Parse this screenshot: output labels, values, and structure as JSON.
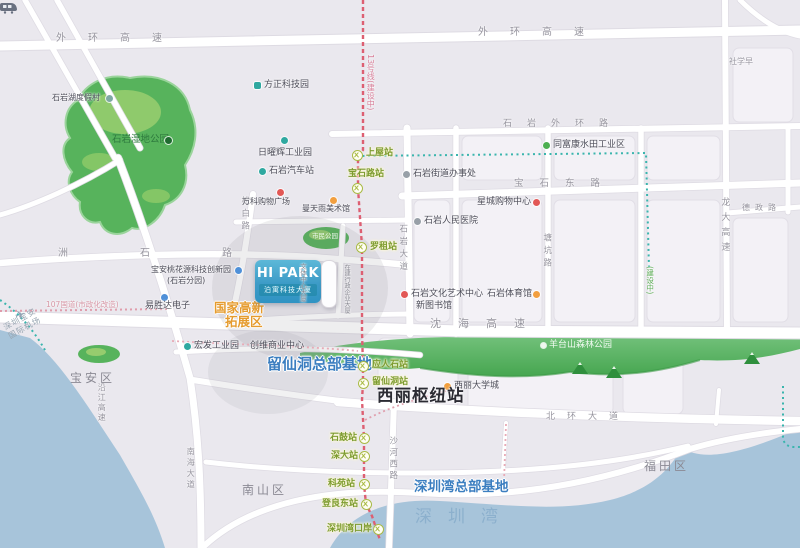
{
  "colors": {
    "brand_blue": "#3d9bc7",
    "hq_blue": "#3b7ec0",
    "zone_orange": "#e59b2e",
    "line13_red": "#dd5f72",
    "metro_teal": "#3ab5ad",
    "park_green": "#53b357",
    "water_blue": "#a7c4da"
  },
  "map": {
    "brand": {
      "title": "HI PARK",
      "subtitle": "泊寓科技大厦"
    },
    "expressways": [
      {
        "label": "外环高速"
      },
      {
        "label": "外环高速"
      },
      {
        "label": "沈海高速"
      },
      {
        "label": "龙大高速"
      }
    ],
    "roads": [
      {
        "label": "洲石路"
      },
      {
        "label": "石岩外环路"
      },
      {
        "label": "宝石东路"
      },
      {
        "label": "德政路"
      },
      {
        "label": "松白路"
      },
      {
        "label": "石岩大道"
      },
      {
        "label": "塘坑路"
      },
      {
        "label": "沙河西路"
      },
      {
        "label": "北环大道"
      },
      {
        "label": "南海大道"
      },
      {
        "label": "沿江高速"
      },
      {
        "label": "107国道(市政化改造)"
      }
    ],
    "districts": [
      {
        "label": "宝安区"
      },
      {
        "label": "南山区"
      },
      {
        "label": "福田区"
      }
    ],
    "water": {
      "bay_label": "深圳湾"
    },
    "parks": [
      {
        "label": "石岩湿地公园"
      },
      {
        "label": "羊台山森林公园"
      },
      {
        "label": "市民公园"
      }
    ],
    "zones": {
      "hi_tech_line1": "国家高新",
      "hi_tech_line2": "拓展区",
      "liuxiandong": "留仙洞总部基地",
      "shenzhenwan": "深圳湾总部基地"
    },
    "hub": {
      "label": "西丽枢纽站"
    },
    "airport": {
      "icon": "✈",
      "line1": "深圳宝安",
      "line2": "国际机场"
    },
    "buildings": [
      {
        "label": "文体中心大厦"
      },
      {
        "label": "在建行政企业大厦"
      }
    ],
    "pois": [
      {
        "label": "石岩湖度假村"
      },
      {
        "label": "方正科技园"
      },
      {
        "label": "日曜辉工业园"
      },
      {
        "label": "石岩汽车站"
      },
      {
        "label": "同富康水田工业区"
      },
      {
        "label": "石岩街道办事处"
      },
      {
        "label": "星城购物中心"
      },
      {
        "label": "石岩人民医院"
      },
      {
        "label": "石岩文化艺术中心"
      },
      {
        "label": "石岩体育馆"
      },
      {
        "label": "新图书馆"
      },
      {
        "label": "万科购物广场"
      },
      {
        "label": "曼天雨美术馆"
      },
      {
        "label": "宝安桃花源科技创新园"
      },
      {
        "label": "(石岩分园)"
      },
      {
        "label": "易胜达电子"
      },
      {
        "label": "宏发工业园"
      },
      {
        "label": "创维商业中心"
      },
      {
        "label": "西丽大学城"
      },
      {
        "label": "社学早"
      }
    ],
    "stations": [
      {
        "label": "上屋站"
      },
      {
        "label": "宝石路站"
      },
      {
        "label": "罗租站"
      },
      {
        "label": "应人石站"
      },
      {
        "label": "留仙洞站"
      },
      {
        "label": "石鼓站"
      },
      {
        "label": "深大站"
      },
      {
        "label": "科苑站"
      },
      {
        "label": "登良东站"
      },
      {
        "label": "深圳湾口岸"
      }
    ],
    "metro_notes": [
      {
        "label": "13号线(建设中)"
      },
      {
        "label": "(建设中)"
      }
    ]
  }
}
